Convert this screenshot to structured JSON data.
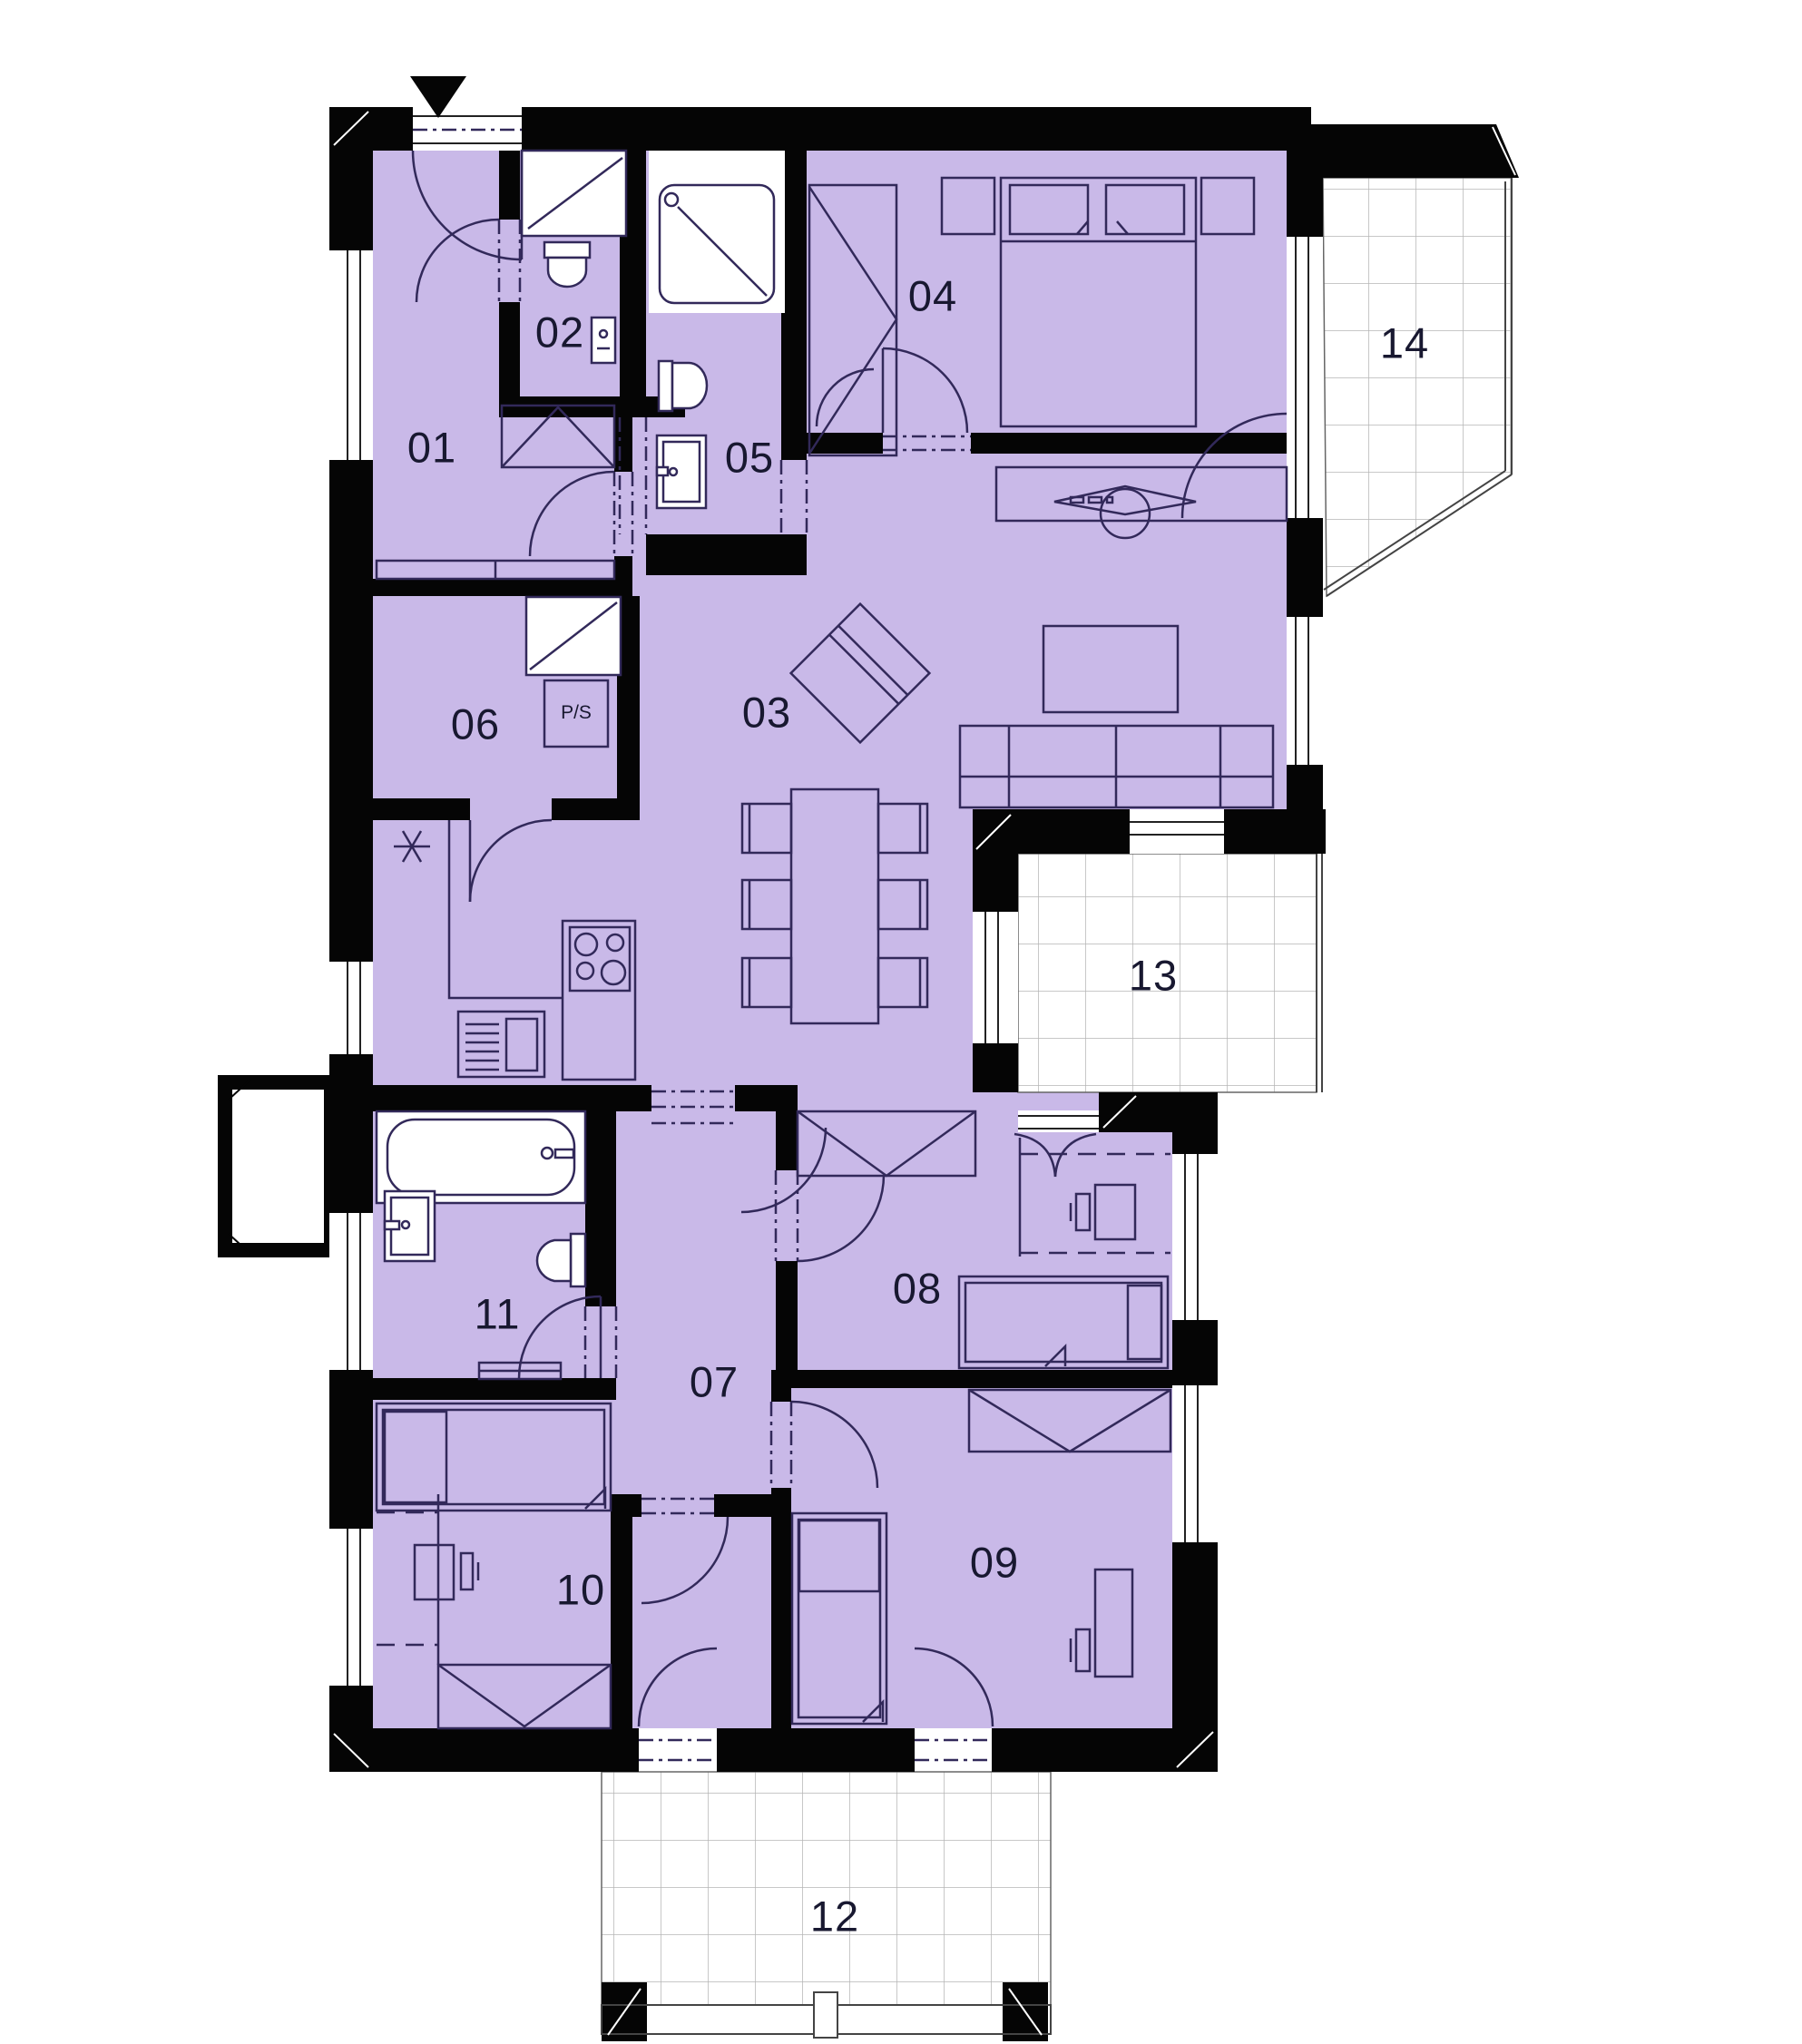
{
  "plan": {
    "type": "apartment-floor-plan",
    "colors": {
      "room_fill": "#c9b9e8",
      "wall": "#050505",
      "furniture_line": "#32295a",
      "tile_grid": "#b5b5b5",
      "background": "#ffffff"
    },
    "icons": {
      "entrance": "down-triangle-arrow",
      "utility_marker": "six-spoke-star"
    },
    "rooms": [
      {
        "id": "01",
        "label": "01"
      },
      {
        "id": "02",
        "label": "02"
      },
      {
        "id": "03",
        "label": "03"
      },
      {
        "id": "04",
        "label": "04"
      },
      {
        "id": "05",
        "label": "05"
      },
      {
        "id": "06",
        "label": "06"
      },
      {
        "id": "07",
        "label": "07"
      },
      {
        "id": "08",
        "label": "08"
      },
      {
        "id": "09",
        "label": "09"
      },
      {
        "id": "10",
        "label": "10"
      },
      {
        "id": "11",
        "label": "11"
      },
      {
        "id": "12",
        "label": "12"
      },
      {
        "id": "13",
        "label": "13"
      },
      {
        "id": "14",
        "label": "14"
      }
    ],
    "markers": {
      "ps_label": "P/S"
    }
  }
}
